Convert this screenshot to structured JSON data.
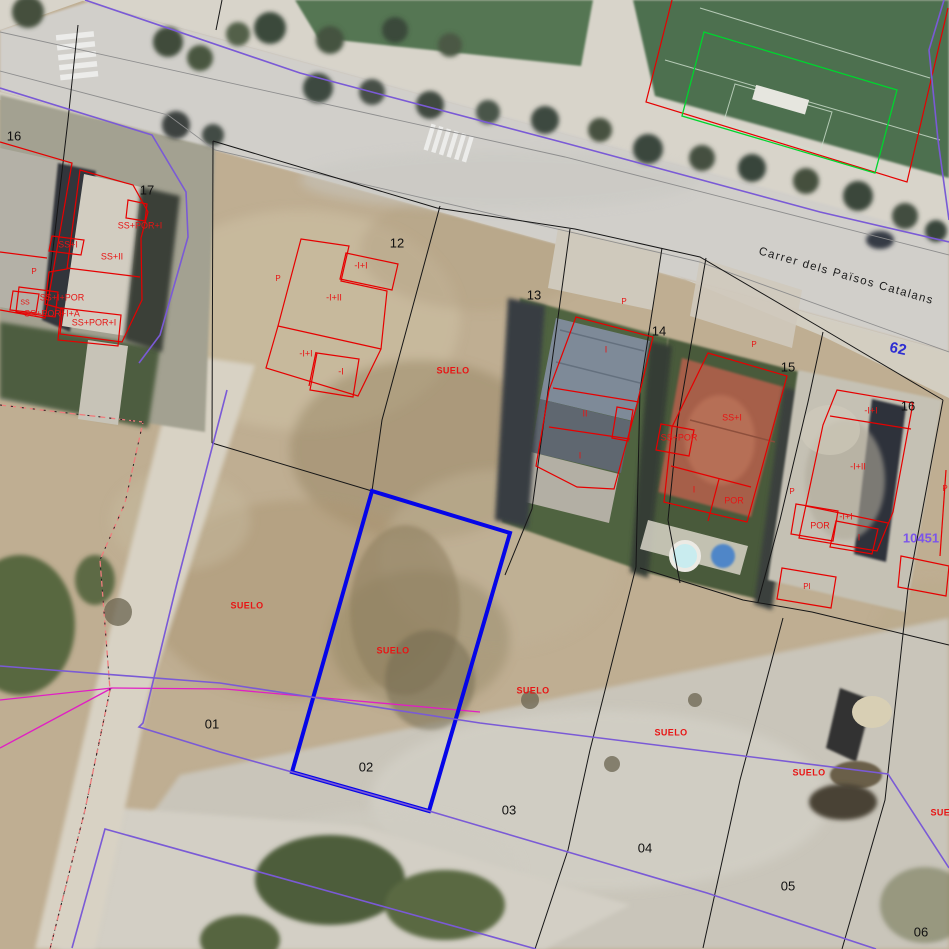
{
  "map_type": "cadastral-orthophoto-viewer",
  "street": {
    "t": "Carrer dels Països Catalans",
    "x": 846,
    "y": 277,
    "r": 16
  },
  "refs": [
    {
      "t": "62",
      "x": 898,
      "y": 349,
      "s": 15,
      "r": 12,
      "color": "#2d2dd2"
    },
    {
      "t": "10451",
      "x": 921,
      "y": 538,
      "s": 13,
      "r": 0,
      "color": "#7b55ea"
    }
  ],
  "parcel_numbers": [
    {
      "t": "16",
      "x": 14,
      "y": 136
    },
    {
      "t": "17",
      "x": 147,
      "y": 190
    },
    {
      "t": "12",
      "x": 397,
      "y": 243
    },
    {
      "t": "13",
      "x": 534,
      "y": 295
    },
    {
      "t": "14",
      "x": 659,
      "y": 331
    },
    {
      "t": "15",
      "x": 788,
      "y": 367
    },
    {
      "t": "16",
      "x": 908,
      "y": 406
    },
    {
      "t": "01",
      "x": 212,
      "y": 724
    },
    {
      "t": "02",
      "x": 366,
      "y": 767
    },
    {
      "t": "03",
      "x": 509,
      "y": 810
    },
    {
      "t": "04",
      "x": 645,
      "y": 848
    },
    {
      "t": "05",
      "x": 788,
      "y": 886
    },
    {
      "t": "06",
      "x": 921,
      "y": 932
    }
  ],
  "suelo_labels": [
    {
      "t": "SUELO",
      "x": 453,
      "y": 371
    },
    {
      "t": "SUELO",
      "x": 247,
      "y": 606
    },
    {
      "t": "SUELO",
      "x": 393,
      "y": 651
    },
    {
      "t": "SUELO",
      "x": 533,
      "y": 691
    },
    {
      "t": "SUELO",
      "x": 671,
      "y": 733
    },
    {
      "t": "SUELO",
      "x": 809,
      "y": 773
    },
    {
      "t": "SUELO",
      "x": 947,
      "y": 813
    }
  ],
  "building_annotations": [
    {
      "t": "SS+POR+I",
      "x": 140,
      "y": 226
    },
    {
      "t": "SS+I",
      "x": 68,
      "y": 245
    },
    {
      "t": "SS+II",
      "x": 112,
      "y": 257
    },
    {
      "t": "P",
      "x": 34,
      "y": 272,
      "s": 8
    },
    {
      "t": "SS+I+POR",
      "x": 62,
      "y": 298
    },
    {
      "t": "SS+POR+I+A",
      "x": 52,
      "y": 314
    },
    {
      "t": "SS+POR+I",
      "x": 94,
      "y": 323
    },
    {
      "t": "SS",
      "x": 25,
      "y": 303,
      "s": 7
    },
    {
      "t": "P",
      "x": 278,
      "y": 279,
      "s": 8
    },
    {
      "t": "-I+I",
      "x": 361,
      "y": 266
    },
    {
      "t": "-I+II",
      "x": 334,
      "y": 298
    },
    {
      "t": "-I+I",
      "x": 306,
      "y": 354
    },
    {
      "t": "-I",
      "x": 341,
      "y": 372
    },
    {
      "t": "P",
      "x": 624,
      "y": 302,
      "s": 8
    },
    {
      "t": "I",
      "x": 606,
      "y": 350
    },
    {
      "t": "II",
      "x": 585,
      "y": 414
    },
    {
      "t": "I",
      "x": 580,
      "y": 456
    },
    {
      "t": "SS+POR",
      "x": 679,
      "y": 438
    },
    {
      "t": "P",
      "x": 754,
      "y": 345,
      "s": 8
    },
    {
      "t": "SS+I",
      "x": 732,
      "y": 418
    },
    {
      "t": "I",
      "x": 694,
      "y": 490
    },
    {
      "t": "POR",
      "x": 734,
      "y": 501
    },
    {
      "t": "P",
      "x": 792,
      "y": 492,
      "s": 8
    },
    {
      "t": "-I+I",
      "x": 871,
      "y": 411
    },
    {
      "t": "-I+II",
      "x": 858,
      "y": 467
    },
    {
      "t": "-I+I",
      "x": 846,
      "y": 517
    },
    {
      "t": "POR",
      "x": 820,
      "y": 526
    },
    {
      "t": "I",
      "x": 859,
      "y": 538
    },
    {
      "t": "PI",
      "x": 807,
      "y": 587,
      "s": 8
    },
    {
      "t": "P",
      "x": 945,
      "y": 489,
      "s": 8
    }
  ],
  "layers": {
    "parcel_lines": "#161616",
    "curb_lines": "#8e8e8e",
    "cadastral_buildings": "#e60000",
    "sports_overlay": "#00d42e",
    "other_boundary": "#e11ec4",
    "path_line": "#ef7d7d",
    "urban_boundary": "#7a5ad6",
    "selected_parcel": "#0505e8",
    "label_red": "#e81414",
    "label_black": "#101010"
  },
  "selected_parcel": {
    "number": "02",
    "label_inside": "SUELO"
  }
}
